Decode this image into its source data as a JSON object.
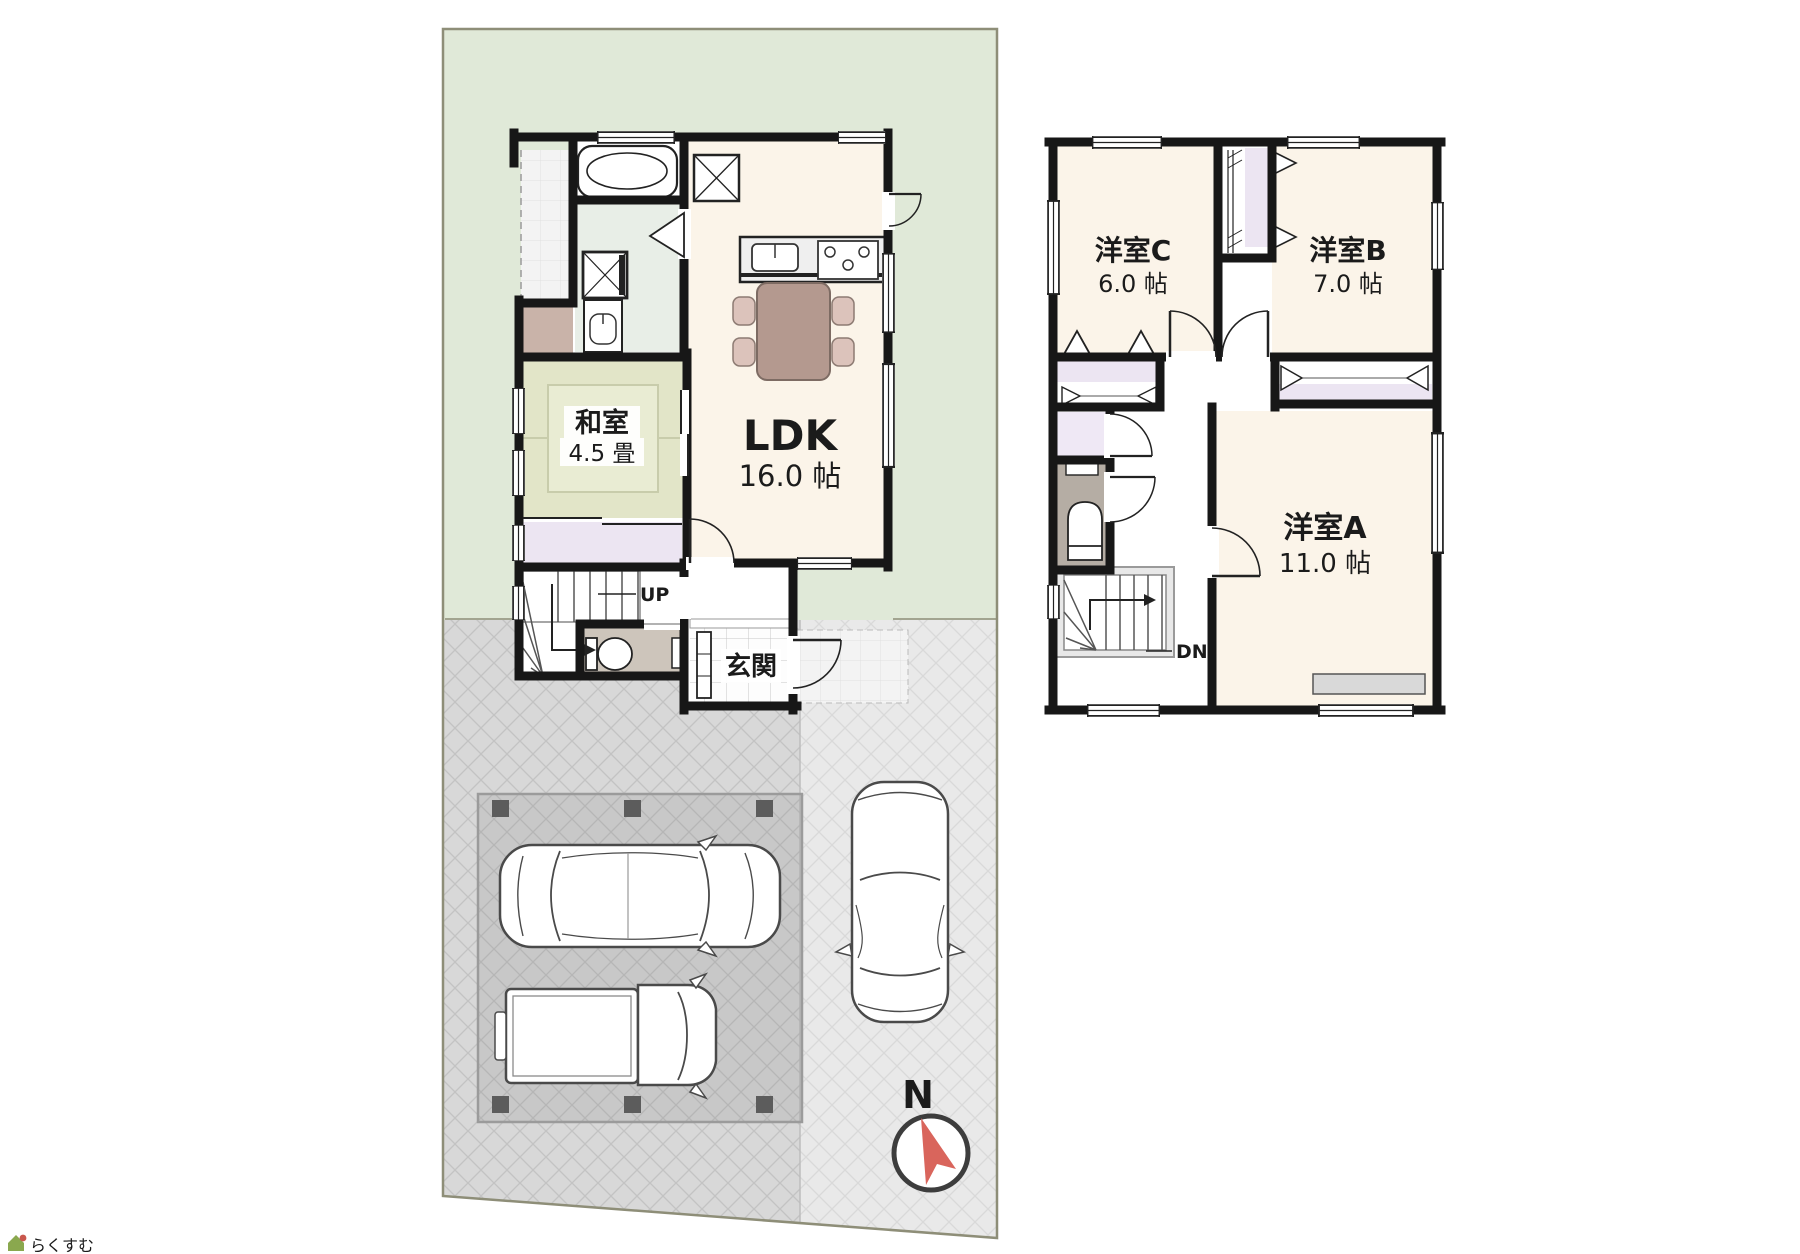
{
  "site": {
    "north_label": "N",
    "logo_text": "らくすむ"
  },
  "floor1": {
    "rooms": {
      "washitsu": {
        "label": "和室",
        "size": "4.5 畳"
      },
      "ldk": {
        "label": "LDK",
        "size": "16.0 帖"
      },
      "genkan": {
        "label": "玄関"
      }
    },
    "stairs": {
      "label": "UP"
    }
  },
  "floor2": {
    "rooms": {
      "c": {
        "label": "洋室C",
        "size": "6.0 帖"
      },
      "b": {
        "label": "洋室B",
        "size": "7.0 帖"
      },
      "a": {
        "label": "洋室A",
        "size": "11.0 帖"
      }
    },
    "stairs": {
      "label": "DN"
    }
  },
  "colors": {
    "garden": "#e0e9d8",
    "driveway": "#d8d8d8",
    "driveway_light": "#e9e9e9",
    "plot_border": "#8e8e78",
    "wall": "#171717",
    "room_floor": "#fbf4e9",
    "tatami": "#e2e5c8",
    "closet": "#ece5f2",
    "washroom": "#e8eee7",
    "toilet_floor_1f": "#cdc5bb",
    "toilet_floor_2f": "#b5ada4",
    "storage_brown": "#c9b3a9",
    "table_brown": "#b4998f",
    "chair_pink": "#dcc3bb",
    "compass_needle": "#d9655c"
  }
}
